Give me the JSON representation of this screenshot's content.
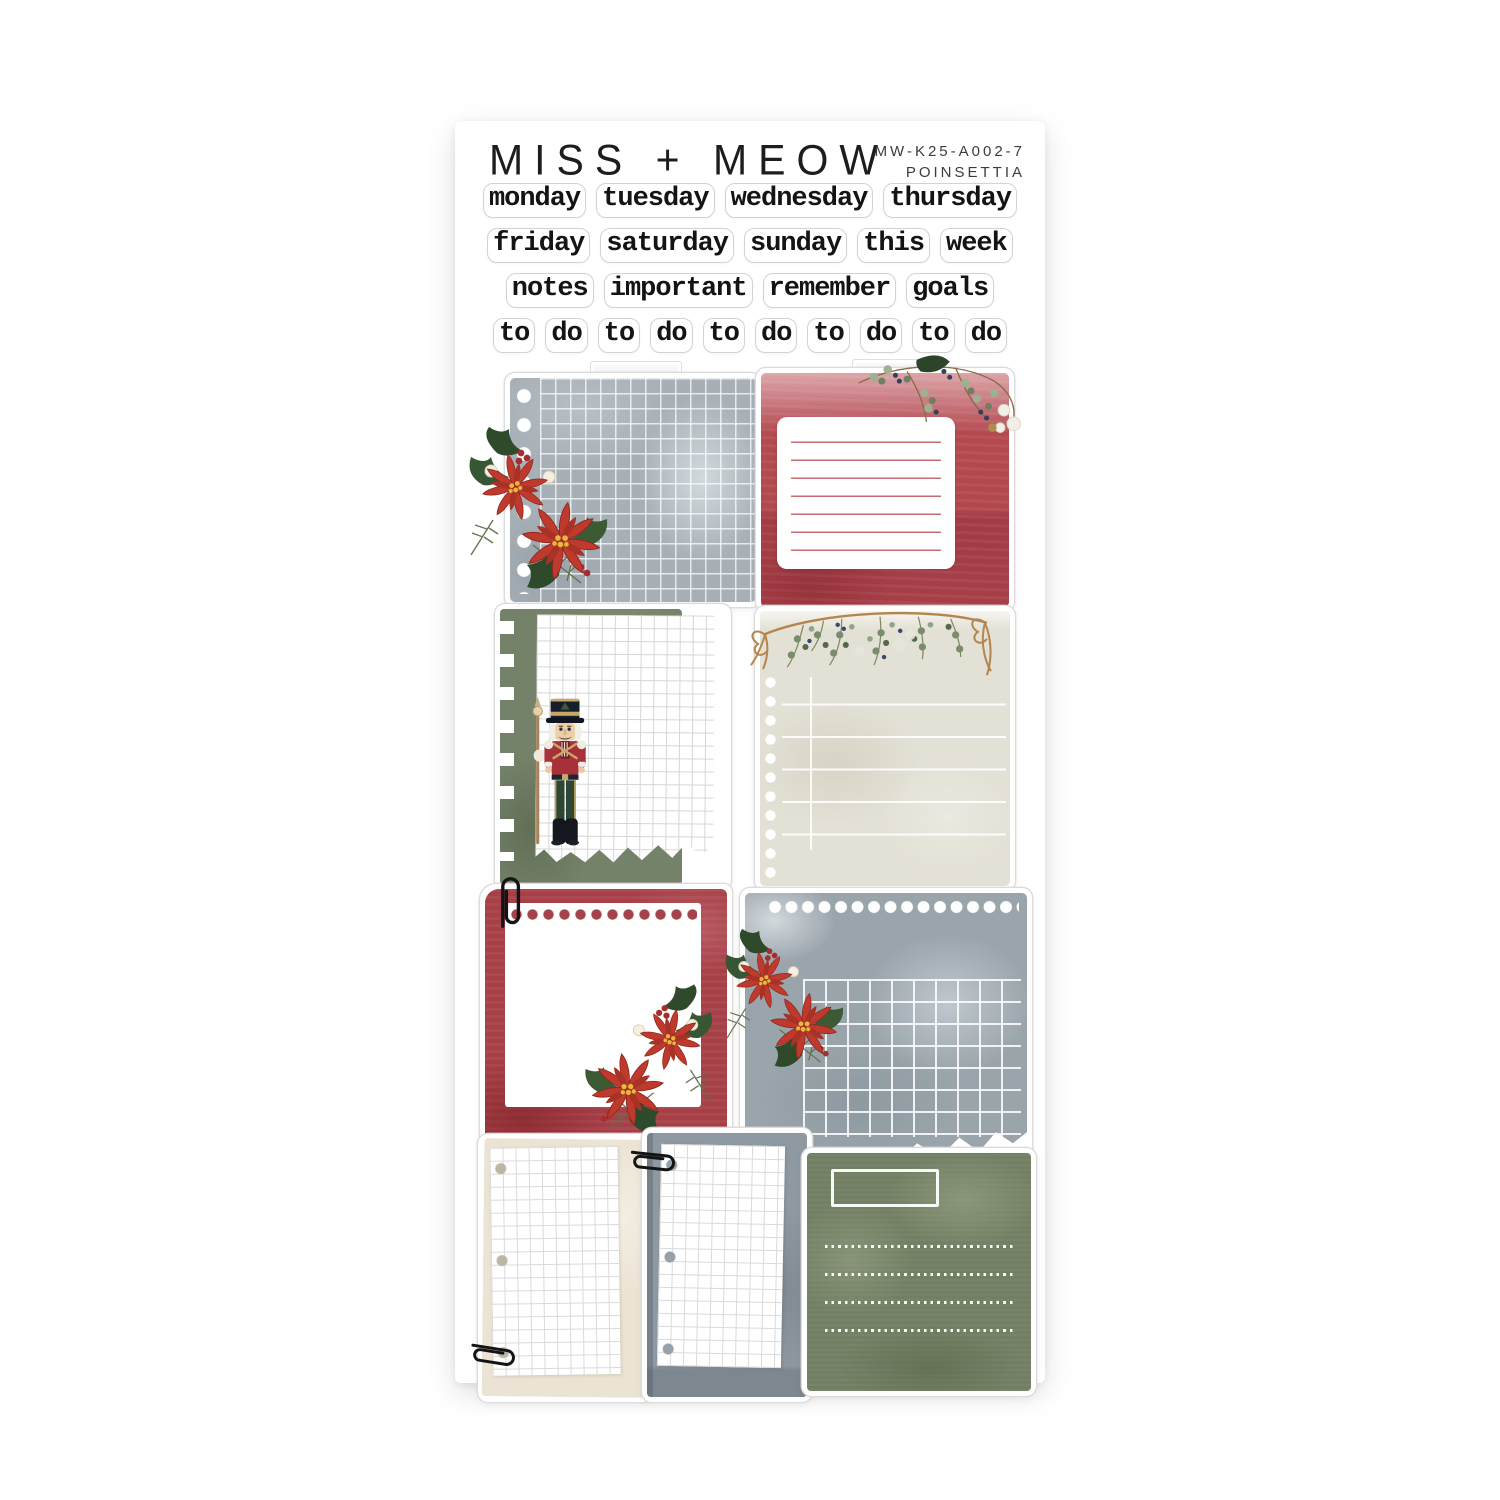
{
  "header": {
    "brand": "MISS + MEOW",
    "sku": "MW-K25-A002-7",
    "collection": "POINSETTIA"
  },
  "words": {
    "rows": [
      [
        "monday",
        "tuesday",
        "wednesday",
        "thursday"
      ],
      [
        "friday",
        "saturday",
        "sunday",
        "this",
        "week"
      ],
      [
        "notes",
        "important",
        "remember",
        "goals"
      ],
      [
        "to",
        "do",
        "to",
        "do",
        "to",
        "do",
        "to",
        "do",
        "to",
        "do"
      ]
    ]
  },
  "stickers": [
    {
      "name": "gray-grid-note-with-poinsettia"
    },
    {
      "name": "red-lined-note-with-greenery"
    },
    {
      "name": "green-grid-note-with-nutcracker"
    },
    {
      "name": "cream-note-with-garland"
    },
    {
      "name": "red-frame-note-with-paperclip-and-poinsettia"
    },
    {
      "name": "gray-torn-grid-note-with-poinsettia"
    },
    {
      "name": "cream-grid-paper-with-paperclip"
    },
    {
      "name": "gray-grid-paper-with-paperclip"
    },
    {
      "name": "green-label-note-with-dotted-lines"
    }
  ],
  "palette": {
    "red": "#a73f47",
    "green": "#727f63",
    "gray": "#9aa4ab",
    "cream": "#e3e0d5",
    "outline": "#dcdcdc",
    "ink": "#1d1d1d"
  }
}
